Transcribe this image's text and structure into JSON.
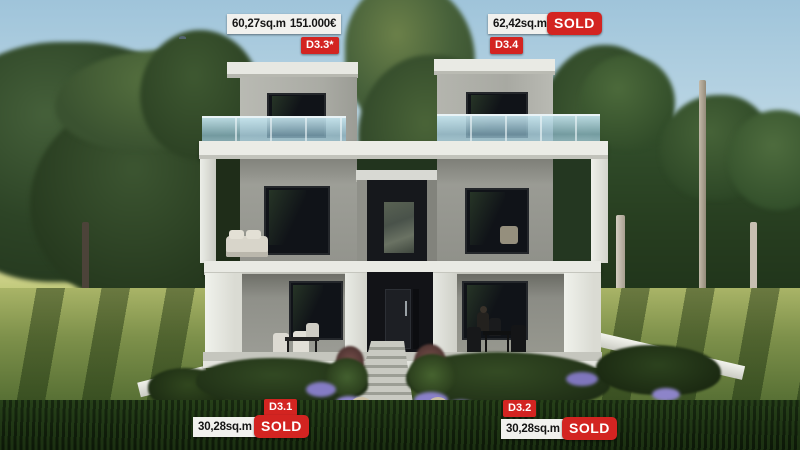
{
  "units": [
    {
      "id": "D3.3*",
      "area": "60,27sq.m",
      "price": "151.000€"
    },
    {
      "id": "D3.4",
      "area": "62,42sq.m",
      "status": "SOLD"
    },
    {
      "id": "D3.1",
      "area": "30,28sq.m",
      "status": "SOLD"
    },
    {
      "id": "D3.2",
      "area": "30,28sq.m",
      "status": "SOLD"
    }
  ],
  "colors": {
    "badge_red": "#d32421",
    "info_background": "#f1f1ee",
    "info_text": "#141414",
    "sold_text": "#ffffff"
  }
}
